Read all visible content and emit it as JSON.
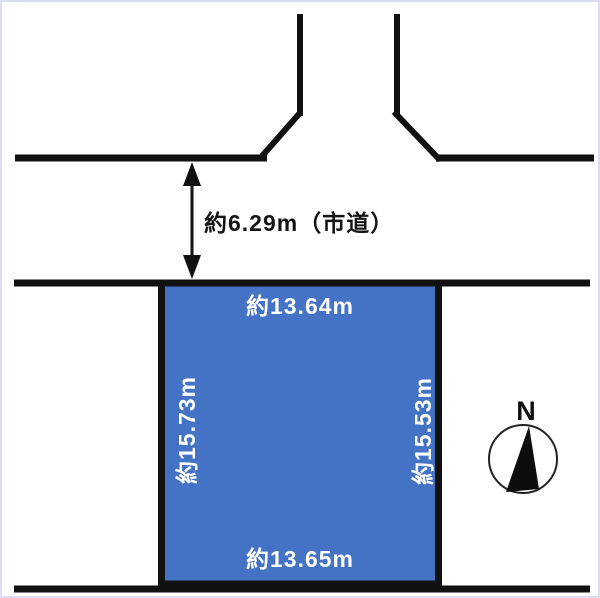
{
  "labels": {
    "road_width": "約6.29m（市道）"
  },
  "plot": {
    "top": "約13.64m",
    "bottom": "約13.65m",
    "left": "約15.73m",
    "right": "約15.53m"
  },
  "compass": {
    "north": "N"
  },
  "colors": {
    "plot_fill": "#4472c4",
    "plot_border": "#111111",
    "line": "#111111",
    "plot_label_text": "#ffffff",
    "road_label_text": "#141414",
    "page_border": "#dcdcf2"
  }
}
